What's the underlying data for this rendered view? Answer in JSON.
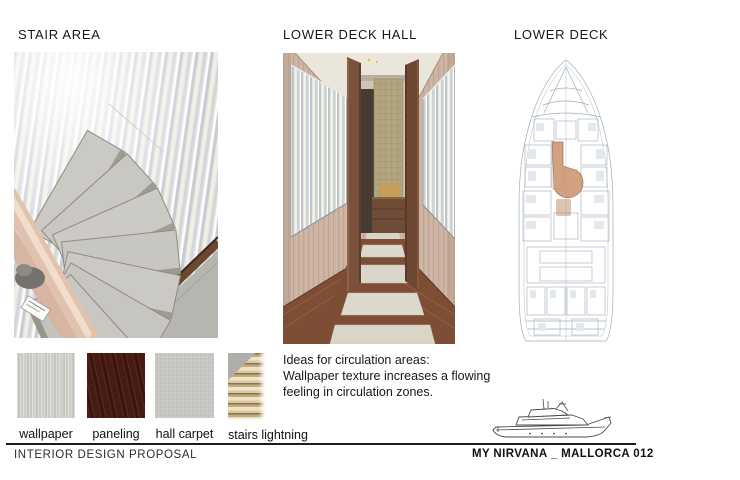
{
  "sections": {
    "stair": {
      "title": "STAIR AREA",
      "image_name": "stair-area-photo"
    },
    "hall": {
      "title": "LOWER DECK HALL",
      "image_name": "lower-deck-hall-photo"
    },
    "deck": {
      "title": "LOWER DECK",
      "image_name": "lower-deck-floorplan"
    }
  },
  "note": {
    "lines": [
      "Ideas for circulation areas:",
      "Wallpaper texture increases a flowing",
      "feeling in circulation zones."
    ]
  },
  "swatches": [
    {
      "label": "wallpaper"
    },
    {
      "label": "paneling"
    },
    {
      "label": "hall carpet"
    },
    {
      "label": "stairs lightning"
    }
  ],
  "footer": {
    "left": "INTERIOR DESIGN PROPOSAL",
    "right": "MY NIRVANA _ MALLORCA 012"
  },
  "colors": {
    "corridor_highlight": "#c78a62",
    "stripe_blue": "#ccd3d7",
    "stripe_cream": "#efeadc",
    "paneling_wood": "#3c1713",
    "carpet_gray": "#c8c7c3",
    "plan_line": "#9fadb9"
  }
}
